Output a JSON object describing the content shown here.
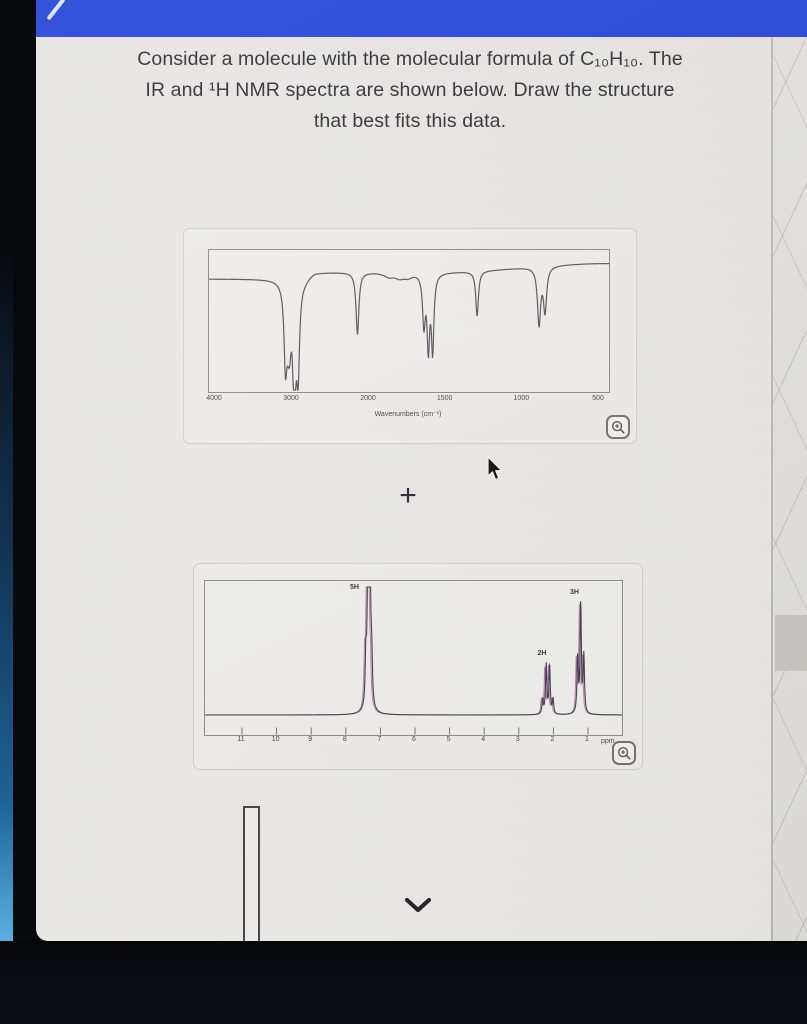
{
  "question": {
    "lines": [
      "Consider a molecule with the molecular formula of C₁₀H₁₀. The",
      "IR and ¹H NMR spectra are shown below. Draw the structure",
      "that best fits this data."
    ]
  },
  "plus_label": "+",
  "colors": {
    "topbar_blue": "#2546d8",
    "ir_line": "#5a5960",
    "nmr_line": "#44434b",
    "nmr_fringe": "#b468aa",
    "plot_border": "#8f8e8a",
    "background": "#eae9e5"
  },
  "chart_data": [
    {
      "type": "line",
      "title": "IR spectrum",
      "xlabel": "Wavenumbers (cm⁻¹)",
      "x_ticks": [
        4000,
        3000,
        2000,
        1500,
        1000,
        500
      ],
      "x_axis_reversed": true,
      "grid": false,
      "plot_height": 142,
      "baseline_transmittance_px": 29,
      "peaks": [
        {
          "wavenumber": 3085,
          "depth": 72,
          "width": 1.7
        },
        {
          "wavenumber": 3052,
          "depth": 33,
          "width": 2.4
        },
        {
          "wavenumber": 3030,
          "depth": 40,
          "width": 2.0
        },
        {
          "wavenumber": 2979,
          "depth": 70,
          "width": 1.5
        },
        {
          "wavenumber": 2956,
          "depth": 50,
          "width": 1.4
        },
        {
          "wavenumber": 2921,
          "depth": 90,
          "width": 1.7
        },
        {
          "wavenumber": 2150,
          "depth": 62,
          "width": 1.7
        },
        {
          "wavenumber": 1870,
          "depth": 4,
          "width": 6
        },
        {
          "wavenumber": 1800,
          "depth": 5,
          "width": 6
        },
        {
          "wavenumber": 1745,
          "depth": 4,
          "width": 5
        },
        {
          "wavenumber": 1642,
          "depth": 50,
          "width": 1.6
        },
        {
          "wavenumber": 1613,
          "depth": 72,
          "width": 1.5
        },
        {
          "wavenumber": 1585,
          "depth": 76,
          "width": 1.5
        },
        {
          "wavenumber": 1295,
          "depth": 45,
          "width": 1.6
        },
        {
          "wavenumber": 891,
          "depth": 57,
          "width": 1.9
        },
        {
          "wavenumber": 852,
          "depth": 44,
          "width": 1.9
        }
      ]
    },
    {
      "type": "line",
      "title": "1H NMR spectrum",
      "x_ticks": [
        11,
        10,
        9,
        8,
        7,
        6,
        5,
        4,
        3,
        2,
        1
      ],
      "unit_label": "ppm",
      "x_axis_reversed": true,
      "grid": false,
      "plot_height": 154,
      "baseline_y_px": 134,
      "peaks": [
        {
          "label": "5H",
          "center_ppm": 7.33,
          "label_ppm": 7.62,
          "label_top": 20,
          "lines": [
            [
              7.42,
              48
            ],
            [
              7.37,
              86
            ],
            [
              7.33,
              124
            ],
            [
              7.29,
              90
            ],
            [
              7.25,
              42
            ]
          ],
          "broad_base": [
            7.33,
            14,
            3.2
          ]
        },
        {
          "label": "2H",
          "center_ppm": 2.16,
          "label_ppm": 2.2,
          "label_top": 86,
          "lines": [
            [
              2.31,
              15
            ],
            [
              2.21,
              50
            ],
            [
              2.11,
              50
            ],
            [
              2.01,
              15
            ]
          ]
        },
        {
          "label": "3H",
          "center_ppm": 1.21,
          "label_ppm": 1.26,
          "label_top": 25,
          "lines": [
            [
              1.3,
              57
            ],
            [
              1.21,
              111
            ],
            [
              1.12,
              57
            ]
          ]
        }
      ]
    }
  ]
}
